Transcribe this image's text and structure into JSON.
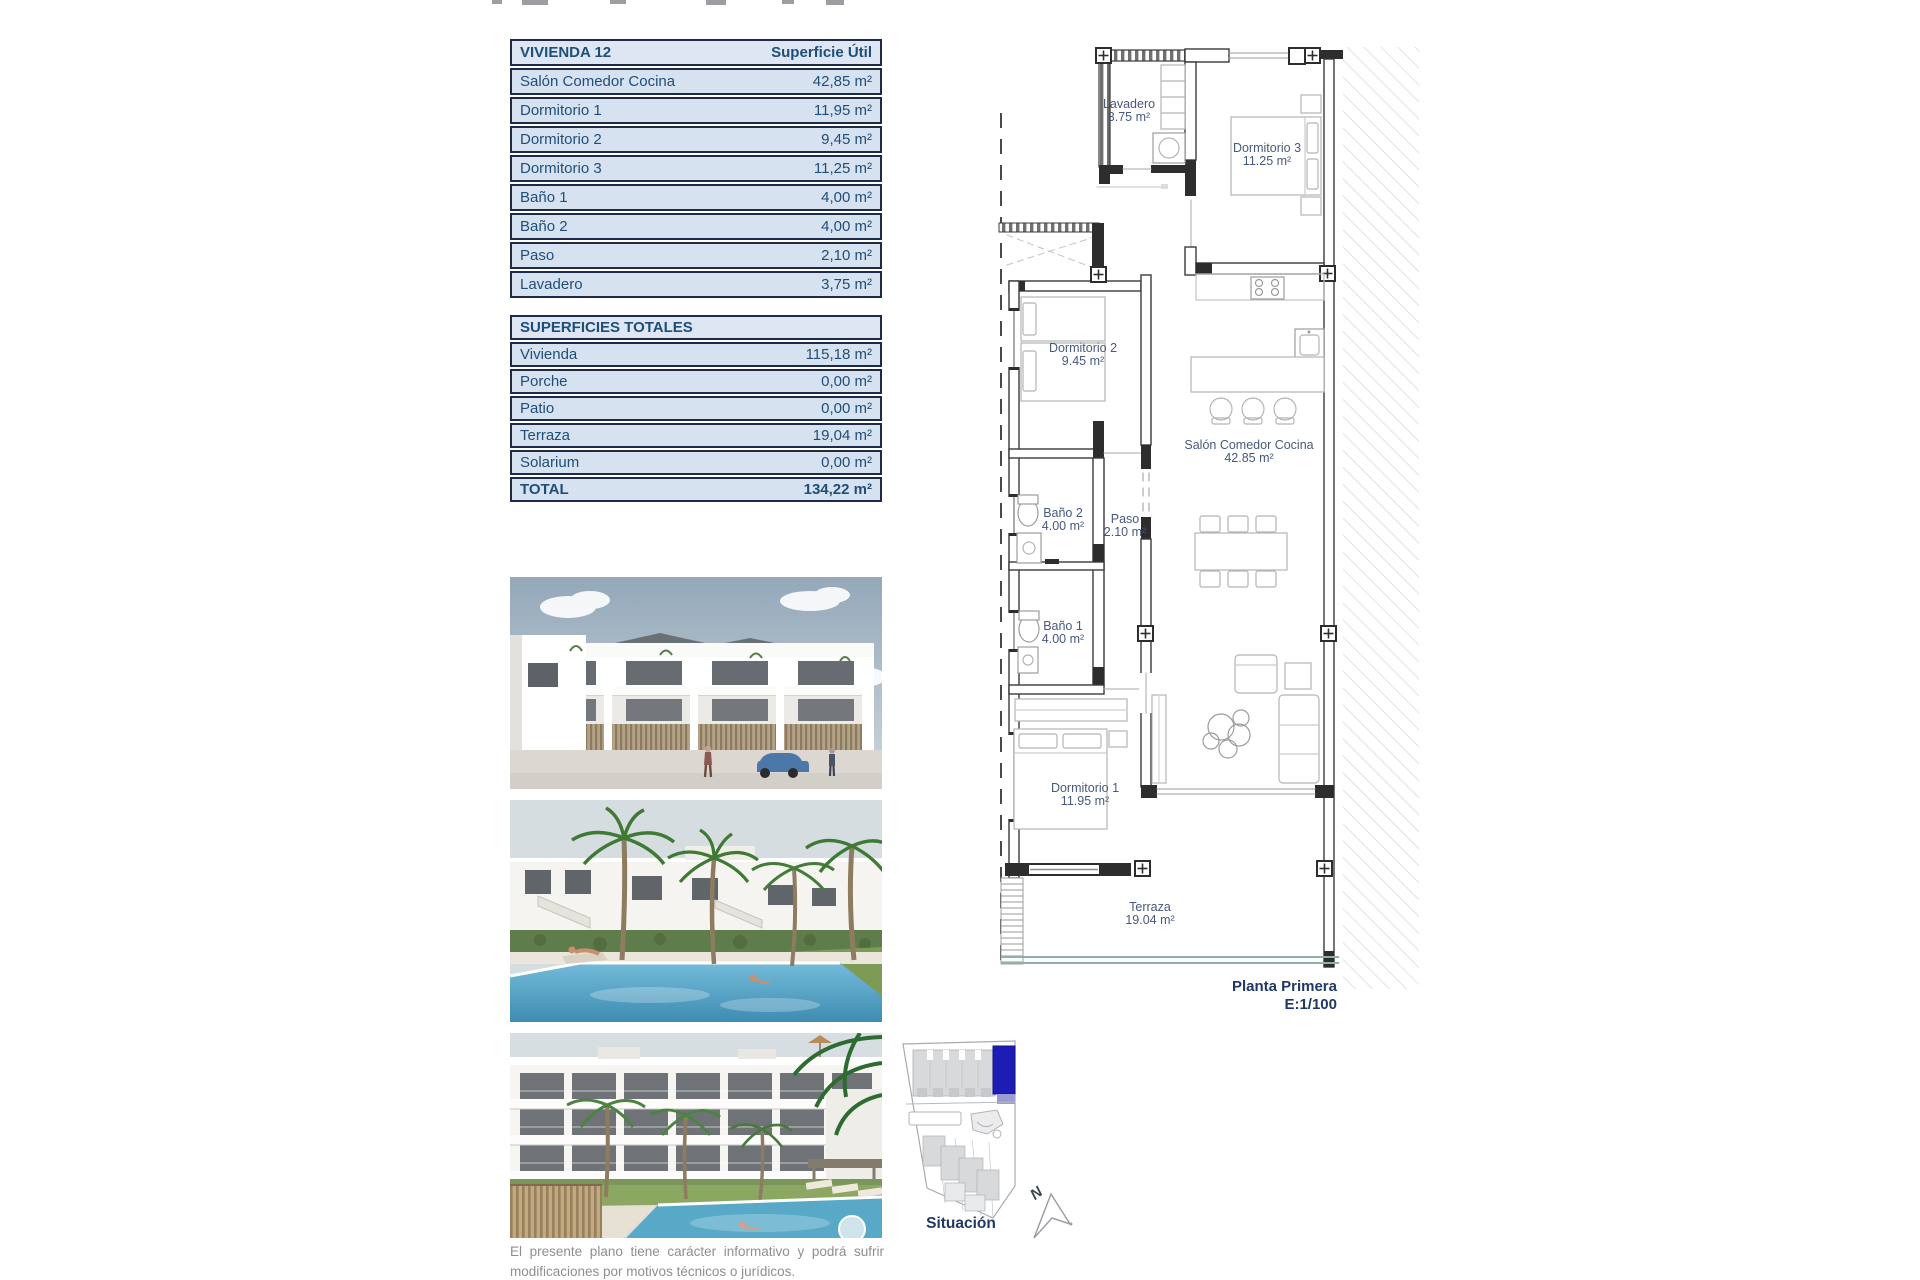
{
  "colors": {
    "accent_navy": "#1f4e79",
    "caption_navy": "#1f3864",
    "table_row_bg": "#d7e2f0",
    "table_border": "#1d2b49",
    "plan_label": "#47597e",
    "site_highlight": "#1d1cb5",
    "disclaimer_gray": "#8f8f8f"
  },
  "unit_table": {
    "title": "VIVIENDA 12",
    "header_value": "Superficie Útil",
    "rows": [
      {
        "label": "Salón Comedor Cocina",
        "value": "42,85 m²"
      },
      {
        "label": "Dormitorio 1",
        "value": "11,95 m²"
      },
      {
        "label": "Dormitorio 2",
        "value": "9,45 m²"
      },
      {
        "label": "Dormitorio 3",
        "value": "11,25 m²"
      },
      {
        "label": "Baño 1",
        "value": "4,00 m²"
      },
      {
        "label": "Baño 2",
        "value": "4,00 m²"
      },
      {
        "label": "Paso",
        "value": "2,10 m²"
      },
      {
        "label": "Lavadero",
        "value": "3,75 m²"
      }
    ]
  },
  "totals_table": {
    "title": "SUPERFICIES TOTALES",
    "rows": [
      {
        "label": "Vivienda",
        "value": "115,18 m²"
      },
      {
        "label": "Porche",
        "value": "0,00 m²"
      },
      {
        "label": "Patio",
        "value": "0,00 m²"
      },
      {
        "label": "Terraza",
        "value": "19,04 m²"
      },
      {
        "label": "Solarium",
        "value": "0,00 m²"
      }
    ],
    "total_label": "TOTAL",
    "total_value": "134,22 m²"
  },
  "floorplan": {
    "rooms": {
      "lavadero": {
        "name": "Lavadero",
        "area": "3.75 m²"
      },
      "dormitorio3": {
        "name": "Dormitorio 3",
        "area": "11.25 m²"
      },
      "dormitorio2": {
        "name": "Dormitorio 2",
        "area": "9.45 m²"
      },
      "salon": {
        "name": "Salón Comedor Cocina",
        "area": "42.85 m²"
      },
      "bano2": {
        "name": "Baño 2",
        "area": "4.00 m²"
      },
      "paso": {
        "name": "Paso",
        "area": "2.10 m²"
      },
      "bano1": {
        "name": "Baño 1",
        "area": "4.00 m²"
      },
      "dormitorio1": {
        "name": "Dormitorio 1",
        "area": "11.95 m²"
      },
      "terraza": {
        "name": "Terraza",
        "area": "19.04 m²"
      }
    },
    "caption_title": "Planta Primera",
    "caption_scale": "E:1/100"
  },
  "site_map": {
    "label": "Situación",
    "compass": "N"
  },
  "disclaimer": {
    "line1": "El presente plano tiene carácter informativo y podrá sufrir",
    "line2": "modificaciones por motivos técnicos o jurídicos."
  }
}
